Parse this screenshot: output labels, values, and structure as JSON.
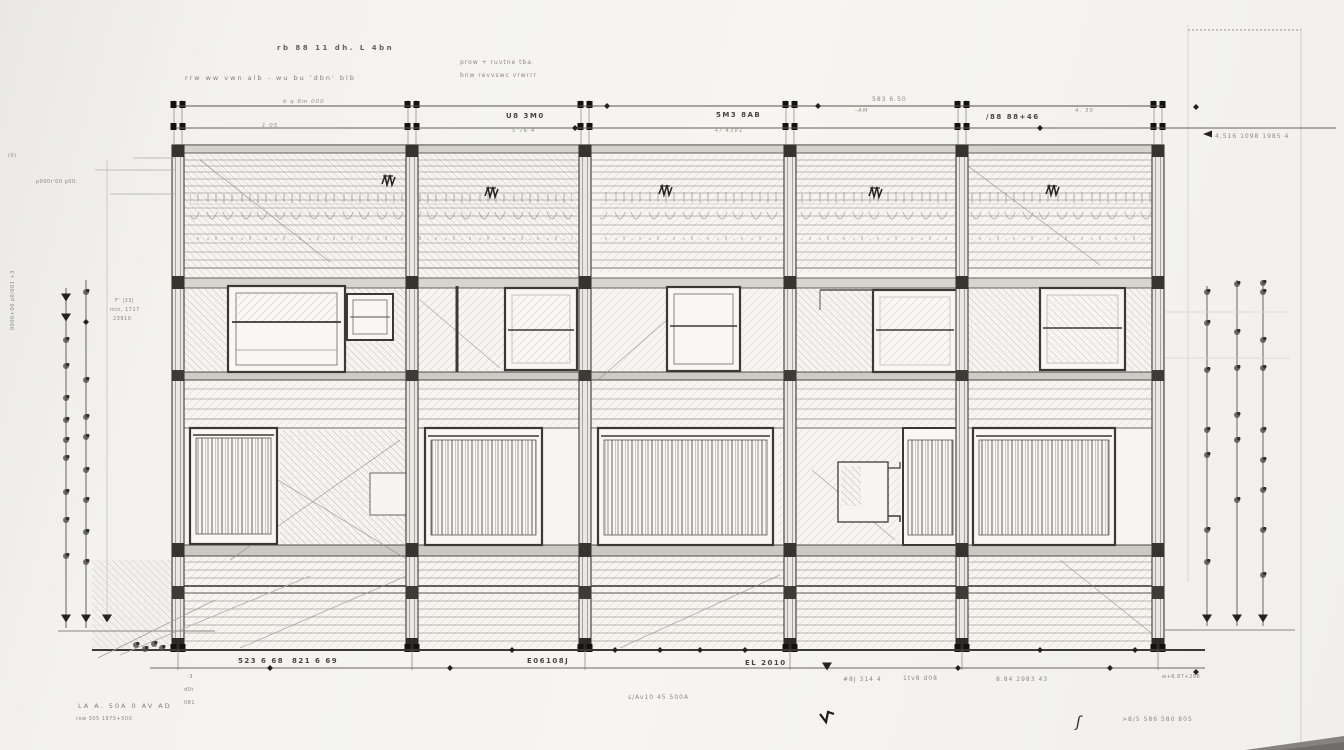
{
  "meta": {
    "type": "architectural elevation sketch, pencil on paper"
  },
  "colors": {
    "paper": "#f3f2ef",
    "ink": "#35342f",
    "pencil": "#a6a39c",
    "band": "#d8d5d0",
    "marker": "#111110",
    "wedge": "#848381"
  },
  "notes_top": {
    "n1": "rb 88 11 dh. L 4bn",
    "n2": "rrw ww vwn alb - wu bu 'dbn' blb",
    "n3": "prow + ruvtne tba.",
    "n4": "bnw revvswc vrwrrr"
  },
  "dims_top": {
    "t1": "b q 8m 000",
    "t1s": "1 05",
    "t2": "U8 3M0",
    "t2s": "5 76 4",
    "t3": "5M3 8AB",
    "t3s": "+/ 43V1",
    "t4": "583 6.50",
    "t4s": "-AM",
    "t5": "/88 88+46",
    "t5s": "4. 35",
    "t6": "4,516 1098 1985 4"
  },
  "notes_left": {
    "l1": "(0)",
    "l2": "p000r'00 p00.",
    "l3": "0000+00 p0/001 +3",
    "l4": "F' |33|",
    "l5": "min, 1717",
    "l6": "23910"
  },
  "dims_bottom": {
    "b1": "523 6 68",
    "b2": "821 6 69",
    "b3": "E06108J",
    "b4": "EL 2010",
    "b5": "#8J 314 4",
    "b6": "1tv8 d08",
    "b7": "8.84 2983 43",
    "b8": "w+8.87+298",
    "b9": "s/Av10 45 500A",
    "b10": ">8/5 586 580 805"
  },
  "notes_bottom": {
    "c1": "LA A. 50A 0 AV AD",
    "c2": "row 305 1975+500",
    "t1": "-3",
    "t2": "d0t",
    "t3": "081",
    "brace": "ʃ"
  }
}
